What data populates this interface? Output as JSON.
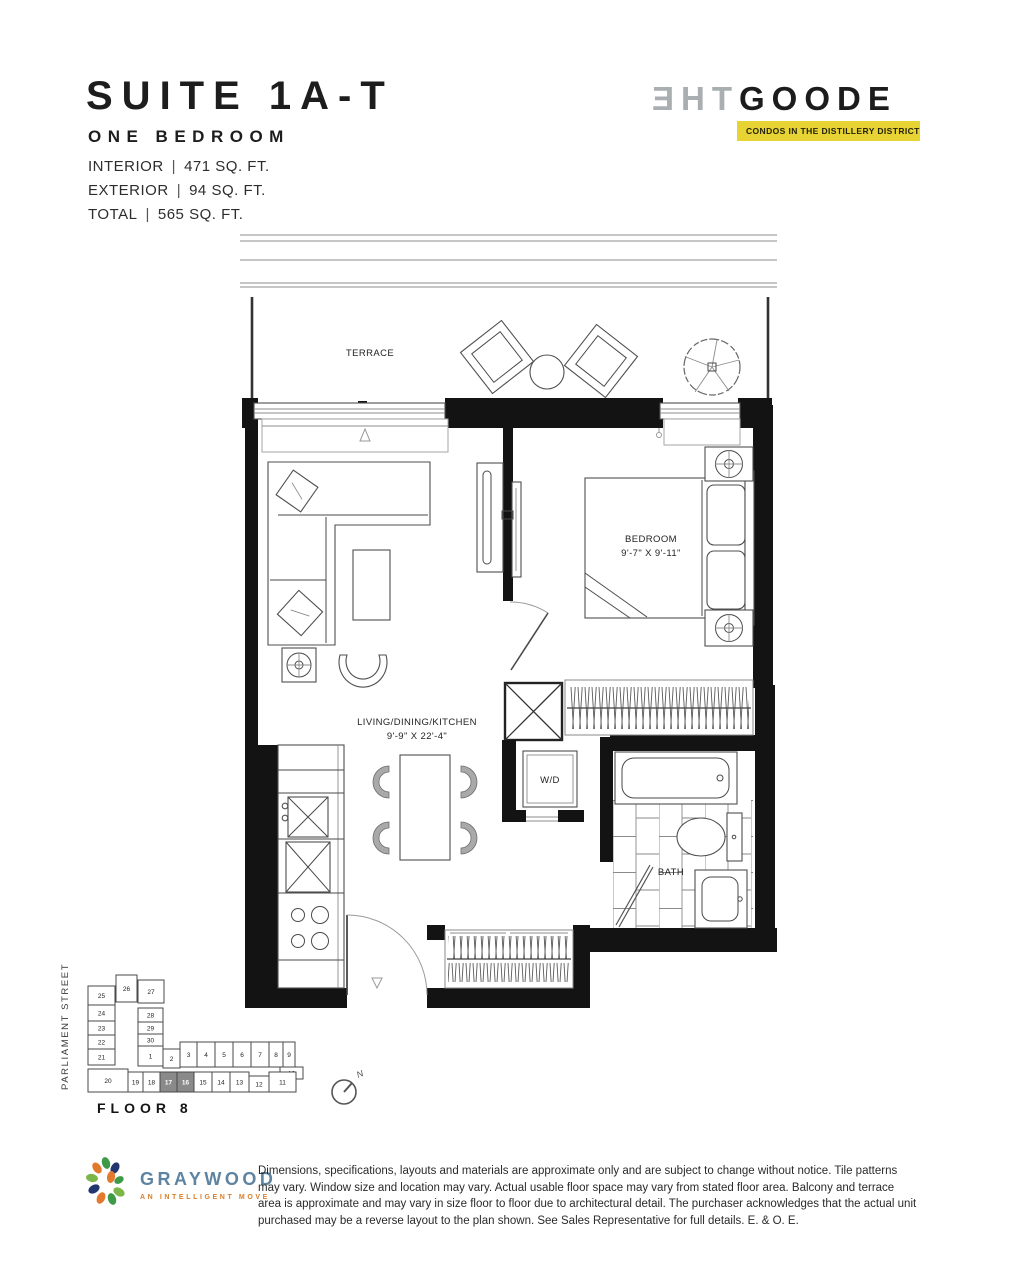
{
  "header": {
    "suite_title": "SUITE 1A-T",
    "suite_subtitle": "ONE BEDROOM",
    "specs": [
      {
        "label": "INTERIOR",
        "sep": "|",
        "value": "471 SQ. FT."
      },
      {
        "label": "EXTERIOR",
        "sep": "|",
        "value": "94 SQ. FT."
      },
      {
        "label": "TOTAL",
        "sep": "|",
        "value": "565 SQ. FT."
      }
    ]
  },
  "logo": {
    "the_reversed": "ƎHT",
    "name": "GOODE",
    "tagline": "CONDOS IN THE DISTILLERY DISTRICT",
    "banner_color": "#e7d334",
    "the_color": "#a9aeb1",
    "name_color": "#1c1c1c"
  },
  "floorplan": {
    "terrace_label": "TERRACE",
    "living_label": "LIVING/DINING/KITCHEN",
    "living_dims": "9'-9\" X 22'-4\"",
    "bedroom_label": "BEDROOM",
    "bedroom_dims": "9'-7\" X 9'-11\"",
    "wd_label": "W/D",
    "bath_label": "BATH"
  },
  "keyplan": {
    "street_label": "PARLIAMENT STREET",
    "floor_label": "FLOOR 8",
    "compass_label": "N",
    "highlighted_units": [
      "17",
      "16"
    ],
    "highlight_color": "#8a8a8a",
    "units": {
      "left_col": [
        "25",
        "24",
        "23",
        "22",
        "21"
      ],
      "mid_col": [
        "26",
        "27",
        "28",
        "29",
        "30"
      ],
      "mid_row": [
        "1",
        "2",
        "3",
        "4",
        "5",
        "6",
        "7",
        "8",
        "9",
        "10"
      ],
      "bottom_row": [
        "20",
        "19",
        "18",
        "17",
        "16",
        "15",
        "14",
        "13",
        "12",
        "11"
      ]
    }
  },
  "footer": {
    "brand_name": "GRAYWOOD",
    "brand_tagline": "AN INTELLIGENT MOVE",
    "disclaimer": "Dimensions, specifications, layouts and materials are approximate only and are subject to change without notice. Tile patterns may vary. Window size and location may vary. Actual usable floor space may vary from stated floor area. Balcony and terrace area is approximate and may vary in size floor to floor due to architectural detail. The purchaser acknowledges that the actual unit purchased may be a reverse layout to the plan shown. See Sales Representative for full details. E. & O. E."
  }
}
